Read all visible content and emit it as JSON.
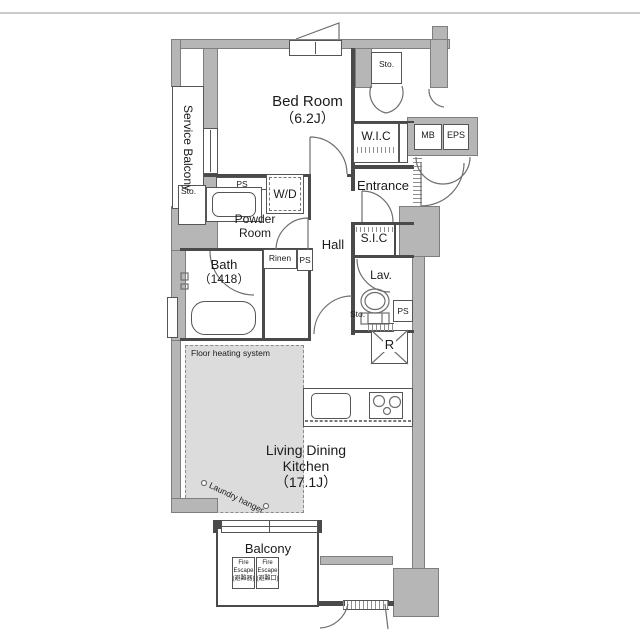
{
  "rooms": {
    "service_balcony": "Service Balcony",
    "bedroom": {
      "name": "Bed Room",
      "area": "（6.2J）"
    },
    "wic": "W.I.C",
    "entrance": "Entrance",
    "sic": "S.I.C",
    "hall": "Hall",
    "powder_room": {
      "line1": "Powder",
      "line2": "Room"
    },
    "lavatory": "Lav.",
    "bath": {
      "name": "Bath",
      "size": "（1418）"
    },
    "ldk": {
      "line1": "Living Dining",
      "line2": "Kitchen",
      "area": "（17.1J）"
    },
    "balcony": "Balcony",
    "wd": "W/D"
  },
  "labels": {
    "sto": "Sto.",
    "ps": "PS",
    "mb": "MB",
    "eps": "EPS",
    "rinen": "Rinen",
    "fridge": "R",
    "floor_heating": "Floor heating system",
    "laundry_hanger": "Laundry hanger"
  },
  "fire_escape": {
    "left": {
      "line1": "Fire",
      "line2": "Escape",
      "line3": "(避難器)"
    },
    "right": {
      "line1": "Fire",
      "line2": "Escape",
      "line3": "(避難口)"
    }
  },
  "colors": {
    "wall": "#b6b6b6",
    "wall_outline": "#7e7e7e",
    "interior_line": "#4a4a4a",
    "heated_floor": "#dcdcdc",
    "text": "#1b1b1b"
  }
}
